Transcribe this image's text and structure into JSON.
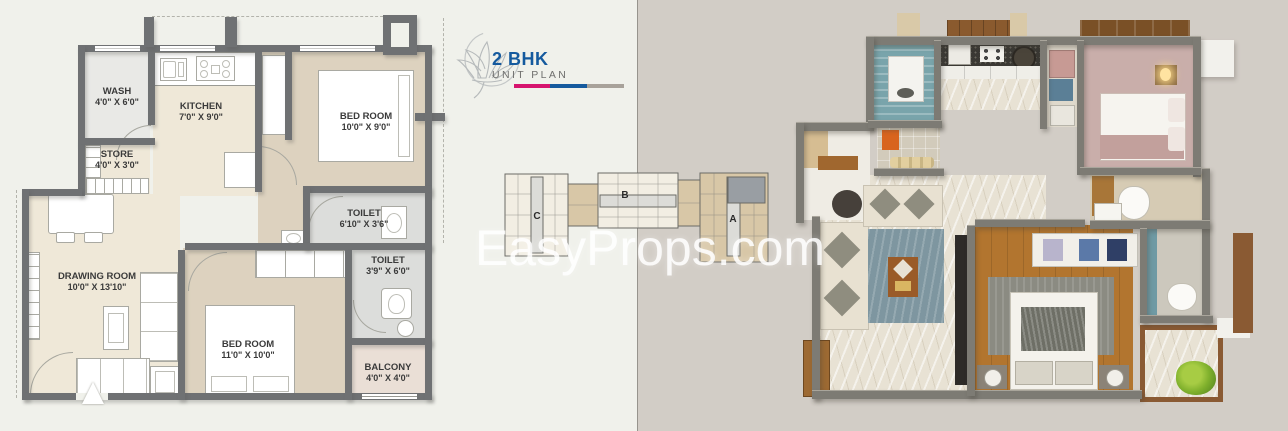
{
  "logo": {
    "title": "2 BHK",
    "subtitle": "UNIT PLAN",
    "title_color": "#155a9e",
    "bar_colors": [
      "#d6146e",
      "#155a9e",
      "#a8a29a"
    ],
    "icon": "lotus-flower-icon"
  },
  "watermark": {
    "text": "EasyProps.com"
  },
  "floorplan_2d": {
    "wall_color": "#6f7173",
    "rooms": [
      {
        "name": "WASH",
        "dims": "4'0\" X 6'0\""
      },
      {
        "name": "KITCHEN",
        "dims": "7'0\" X 9'0\""
      },
      {
        "name": "BED ROOM",
        "dims": "10'0\" X 9'0\""
      },
      {
        "name": "STORE",
        "dims": "4'0\" X 3'0\""
      },
      {
        "name": "DRAWING ROOM",
        "dims": "10'0\" X 13'10\""
      },
      {
        "name": "TOILET",
        "dims": "6'10\" X 3'6\""
      },
      {
        "name": "TOILET",
        "dims": "3'9\" X 6'0\""
      },
      {
        "name": "BED ROOM",
        "dims": "11'0\" X 10'0\""
      },
      {
        "name": "BALCONY",
        "dims": "4'0\" X 4'0\""
      }
    ]
  },
  "key_plan": {
    "blocks": [
      "C",
      "B",
      "A"
    ],
    "highlight_color": "#999ea3",
    "unit_colors": {
      "cream": "#f2eee3",
      "tan": "#d8c7a7",
      "corridor": "#dcdcd8"
    }
  },
  "floorplan_3d": {
    "palette": {
      "background": "#d2cdc6",
      "wall": "#7d7b74",
      "marble_floor": "#e8e2d4",
      "wood_floor": "#b2752f",
      "wash_tile": "#79a4ab",
      "bedroom_carpet": "#c9aeaa",
      "living_rug": "#7e96a0",
      "sofa": "#e8e1d1",
      "plant": "#7fb02c"
    }
  }
}
